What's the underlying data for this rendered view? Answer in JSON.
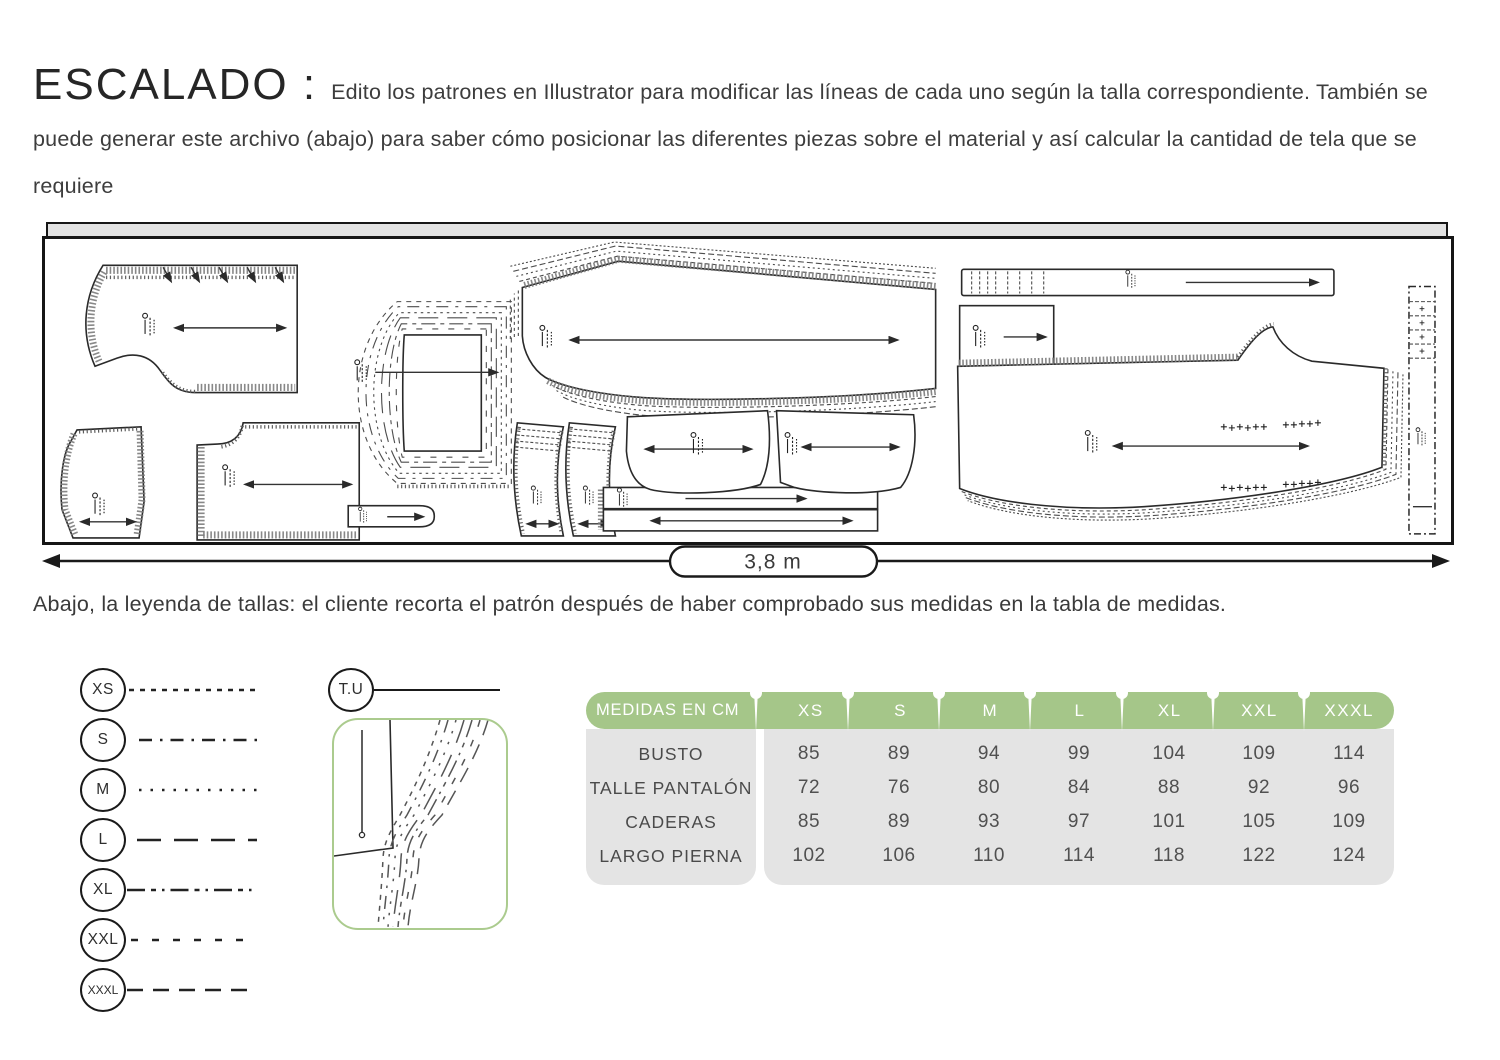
{
  "header": {
    "title": "ESCALADO :",
    "intro": "Edito los patrones en Illustrator para modificar las líneas de cada uno según la talla correspondiente. También se puede generar este archivo (abajo) para saber cómo posicionar las diferentes piezas sobre el material y así calcular la cantidad de tela que se requiere"
  },
  "marker": {
    "width_label": "3,8 m",
    "caption": "Abajo, la leyenda de tallas: el cliente recorta el patrón después de haber comprobado sus medidas en la tabla de medidas."
  },
  "legend": {
    "tu_label": "T.U",
    "sizes": [
      {
        "label": "XS",
        "dash": "5 6"
      },
      {
        "label": "S",
        "dash": "13 8 2.5 8"
      },
      {
        "label": "M",
        "dash": "2.5 9"
      },
      {
        "label": "L",
        "dash": "24 13"
      },
      {
        "label": "XL",
        "dash": "18 6 5 6 2.5 6"
      },
      {
        "label": "XXL",
        "dash": "7 14"
      },
      {
        "label": "XXXL",
        "dash": "16 10"
      }
    ]
  },
  "table": {
    "header_label": "MEDIDAS EN CM",
    "columns": [
      "XS",
      "S",
      "M",
      "L",
      "XL",
      "XXL",
      "XXXL"
    ],
    "rows": [
      {
        "label": "BUSTO",
        "values": [
          "85",
          "89",
          "94",
          "99",
          "104",
          "109",
          "114"
        ]
      },
      {
        "label": "TALLE PANTALÓN",
        "values": [
          "72",
          "76",
          "80",
          "84",
          "88",
          "92",
          "96"
        ]
      },
      {
        "label": "CADERAS",
        "values": [
          "85",
          "89",
          "93",
          "97",
          "101",
          "105",
          "109"
        ]
      },
      {
        "label": "LARGO PIERNA",
        "values": [
          "102",
          "106",
          "110",
          "114",
          "118",
          "122",
          "124"
        ]
      }
    ]
  },
  "colors": {
    "accent_green": "#a5c689",
    "box_green": "#abcb8e",
    "table_gray": "#e4e4e4",
    "text_dark": "#3f3f3f"
  }
}
